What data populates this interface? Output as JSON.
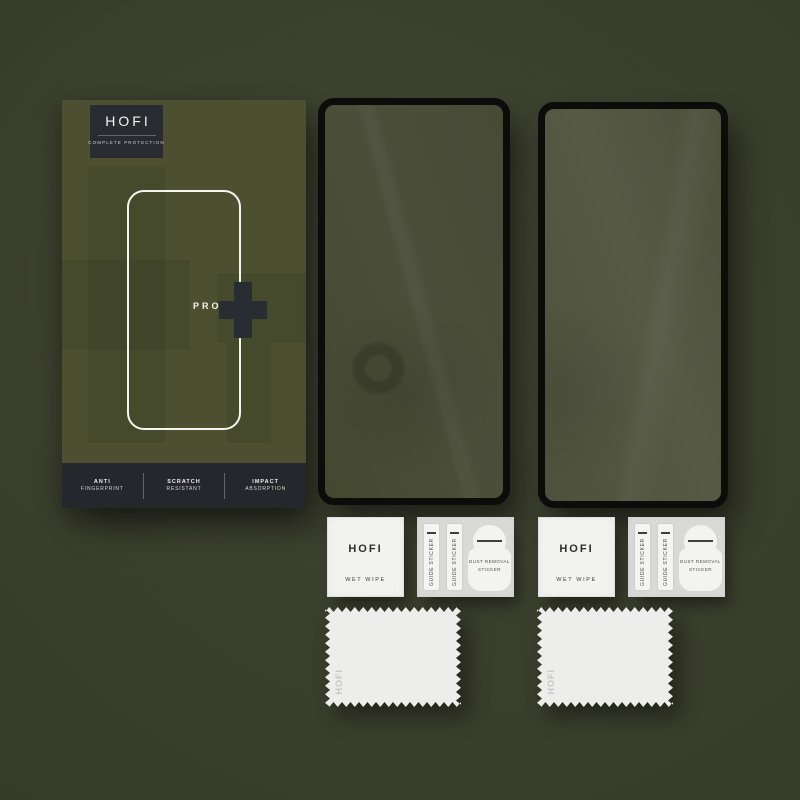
{
  "product": {
    "brand": "HOFI",
    "description": "Tempered glass screen protector retail kit photo",
    "glass_count": 2
  },
  "box": {
    "logo": "HOFI",
    "tagline": "COMPLETE PROTECTION",
    "series_label": "PRO",
    "features": [
      {
        "line1": "ANTI",
        "line2": "FINGERPRINT"
      },
      {
        "line1": "SCRATCH",
        "line2": "RESISTANT"
      },
      {
        "line1": "IMPACT",
        "line2": "ABSORPTION"
      }
    ]
  },
  "accessory_kits": [
    {
      "wet_wipe": {
        "logo": "HOFI",
        "label": "WET WIPE"
      },
      "guide_sticker_labels": [
        "GUIDE STICKER",
        "GUIDE STICKER"
      ],
      "dust_removal_sticker": {
        "line1": "DUST REMOVAL",
        "line2": "STICKER"
      },
      "cloth_logo": "HOFI"
    },
    {
      "wet_wipe": {
        "logo": "HOFI",
        "label": "WET WIPE"
      },
      "guide_sticker_labels": [
        "GUIDE STICKER",
        "GUIDE STICKER"
      ],
      "dust_removal_sticker": {
        "line1": "DUST REMOVAL",
        "line2": "STICKER"
      },
      "cloth_logo": "HOFI"
    }
  ],
  "colors": {
    "background": "#393d2b",
    "box_olive": "#4c5030",
    "dark_charcoal": "#282c30",
    "glass_border": "#0c0d0b",
    "paper_white": "#f2f2f0",
    "panel_gray": "#d9d9d7"
  }
}
